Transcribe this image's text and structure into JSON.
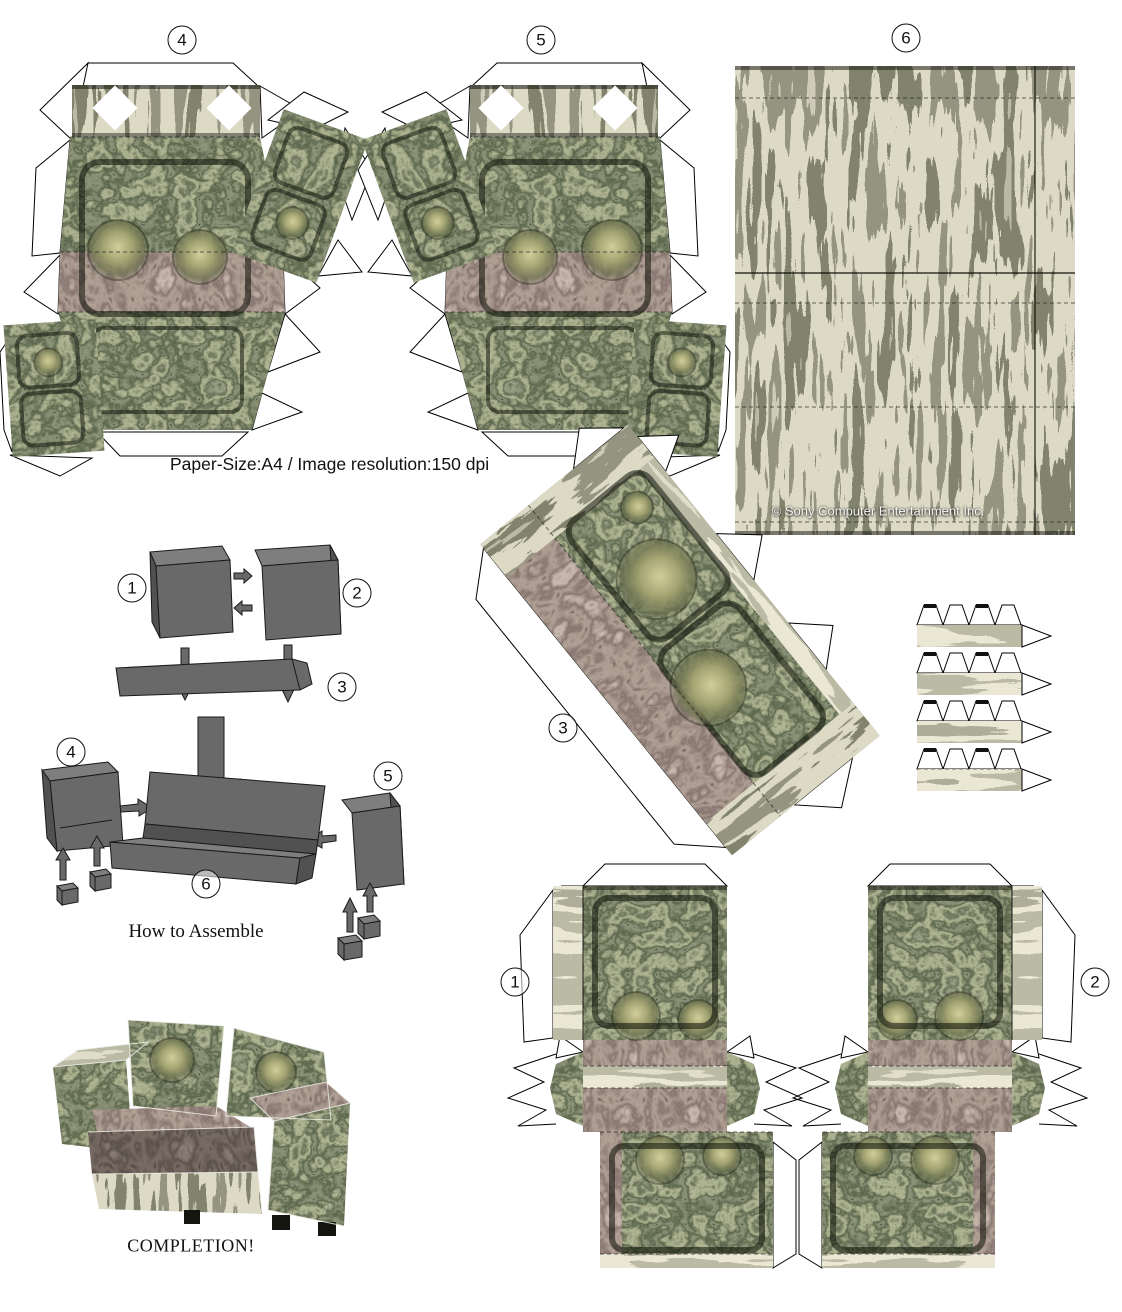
{
  "texts": {
    "paper_info": "Paper-Size:A4 / Image resolution:150 dpi",
    "copyright": "© Sony Computer Entertainment Inc.",
    "how_to_assemble": "How to Assemble",
    "completion": "COMPLETION!"
  },
  "piece_numbers": [
    "1",
    "2",
    "3",
    "4",
    "5",
    "6"
  ],
  "colors": {
    "paper": "#ffffff",
    "outline": "#000000",
    "assembly_grey": "#696969",
    "assembly_grey_top": "#7e7e7e",
    "assembly_grey_side": "#515151",
    "texture_dark_green": "#2a2f24",
    "texture_mid_green": "#4c5240",
    "texture_moss": "#9aa06a",
    "texture_wood_light": "#b0ad93",
    "texture_wood_mid": "#7b7a66",
    "texture_band_brown": "#5e4f49"
  }
}
